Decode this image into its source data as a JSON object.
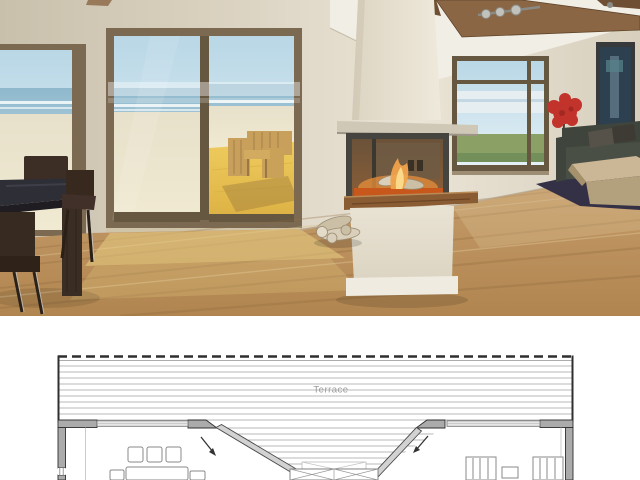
{
  "photo": {
    "description": "3D interior rendering of an open-plan beach house living room with ocean view, panoramic three-sided fireplace, sliding glass doors and dining set"
  },
  "plan": {
    "terrace_label": "Terrace"
  },
  "colors": {
    "wall": "#d8cfbd",
    "wall_light": "#eae4d6",
    "wall_shadow": "#c9c0ac",
    "ceiling": "#f1eee6",
    "beam": "#8a6644",
    "beam_dark": "#6e4f33",
    "metal_light": "#c2c2bc",
    "metal_dark": "#8a8a84",
    "frame_brown": "#7b6a51",
    "frame_dark": "#665741",
    "sky": "#b9d7e6",
    "sky_pale": "#e4f1f6",
    "ocean": "#9dc2d4",
    "surf": "#f2f8fa",
    "sand": "#e7e0ca",
    "sand_warm": "#f1ead2",
    "deck_gold": "#eecb5e",
    "deck_deep": "#ddb143",
    "patio_wood": "#c8a05c",
    "patio_shadow": "#8a6a3a",
    "chimney_light": "#efe9dc",
    "chimney_dark": "#ddd5c2",
    "slab": "#cfc8b7",
    "slab_shadow": "#9d9587",
    "fire_frame": "#46443e",
    "fire_in1": "#6a5239",
    "fire_in2": "#8a5e38",
    "fire_back": "#6f5a44",
    "vent_dark": "#3a3024",
    "ember": "#c8571c",
    "fire_glow": "#e08b3a",
    "flame": "#f0a24a",
    "flame_core": "#fbd98b",
    "log_light": "#d9cfba",
    "log_mid": "#cbbfa6",
    "log_stroke": "#9a8c72",
    "hearth": "#8a5c33",
    "hearth_dark": "#5f3c1e",
    "hearth_light": "#b98a55",
    "base_light": "#e9e3d4",
    "base_dark": "#dcd4c2",
    "plinth": "#f0ebe0",
    "floor1": "#c69d6c",
    "floor2": "#b1854f",
    "floor_line": "#8f6a3e",
    "floor_light": "#d9bf92",
    "sun_patch": "#e9cf84",
    "threshold": "#cfc3a8",
    "sofa": "#4a4f46",
    "sofa_dark": "#3f443c",
    "pillow": "#56524a",
    "pillow_dark": "#3e3a34",
    "rug": "#343147",
    "ctable_top": "#cbb795",
    "ctable_front": "#b3a07c",
    "ctable_side": "#a5916c",
    "lamp_red": "#c1332b",
    "lamp_dark": "#96231e",
    "stem": "#4a4036",
    "art_frame": "#37393a",
    "art_bg": "#2c4050",
    "art_light": "#5d7585",
    "art_teal": "#57848c",
    "grass": "#8aa065",
    "grass_dark": "#74905a",
    "haze": "#e6eef2",
    "water_line": "#c3d8e2",
    "table_top": "#2e2e36",
    "table_edge": "#1f1d22",
    "table_wood": "#3a2d23",
    "chair_wood": "#372a20",
    "chrome": "#c9c9c9",
    "corner_line": "#b8ad97",
    "plan_dark": "#2f2f2f",
    "plan_mid": "#6e6e6e",
    "plan_wall": "#ababab",
    "plan_deck": "#b9b9b9",
    "plan_text": "#9a9a9a",
    "plan_furn": "#8a8a8a",
    "plan_door": "#d2d2d2",
    "plan_win": "#e6e6e6"
  }
}
